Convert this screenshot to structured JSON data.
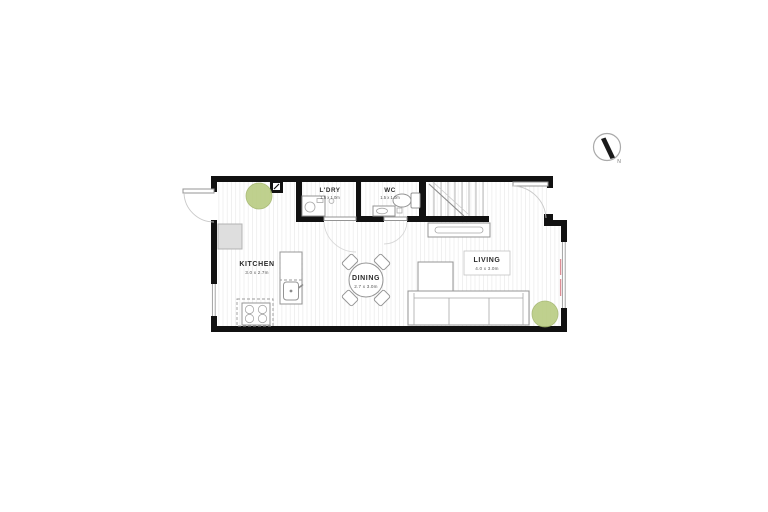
{
  "plan": {
    "type": "floor-plan",
    "level": "ground-floor"
  },
  "rooms": {
    "kitchen": {
      "name": "KITCHEN",
      "dims": "3.0 x 2.7m"
    },
    "dining": {
      "name": "DINING",
      "dims": "2.7 x 3.0m"
    },
    "living": {
      "name": "LIVING",
      "dims": "4.0 x 3.0m"
    },
    "laundry": {
      "name": "L'DRY",
      "dims": "1.5 x 1.0m"
    },
    "wc": {
      "name": "WC",
      "dims": "1.5 x 1.0m"
    }
  },
  "compass": {
    "north_label": "N"
  },
  "icons": {
    "plant": "plant-circle",
    "meter": "meter-box",
    "compass": "north-compass"
  },
  "colors": {
    "wall": "#111111",
    "plant": "#b9cc82",
    "plant_stroke": "#a2b56c",
    "floor_line": "#ededed",
    "fixture_line": "#949494",
    "window_accent": "#dd8e96",
    "fridge_fill": "#dedede"
  }
}
